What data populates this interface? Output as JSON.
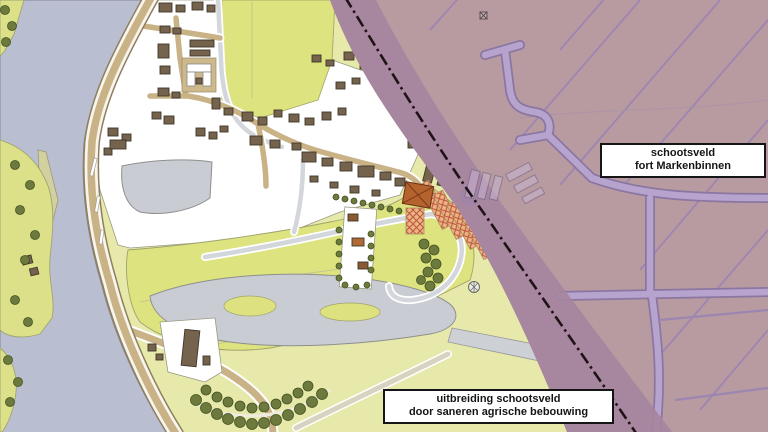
{
  "labels": {
    "schootsveld": {
      "line1": "schootsveld",
      "line2": "fort Markenbinnen"
    },
    "uitbreiding": {
      "line1": "uitbreiding schootsveld",
      "line2": "door saneren agrische bebouwing"
    }
  },
  "colors": {
    "base_field": "#e7e9ab",
    "bright_parcel": "#dde37f",
    "river_water": "#b9bed1",
    "gray_water": "#c9ccd3",
    "village_white": "#ffffff",
    "road_tan": "#c9b286",
    "building_brown": "#75634d",
    "farm_orange": "#b4622e",
    "hatch_fill": "#e9b583",
    "hatch_line": "#c0523c",
    "tree_green": "#6c7a3d",
    "schootsveld_rose": "#b79ba1",
    "boundary_band": "#a5869e",
    "ditch_lavender": "#b7a4ce",
    "boundary_line": "#201316"
  },
  "markers": [
    {
      "name": "crossed-square-marker"
    },
    {
      "name": "circle-cross-marker"
    }
  ]
}
